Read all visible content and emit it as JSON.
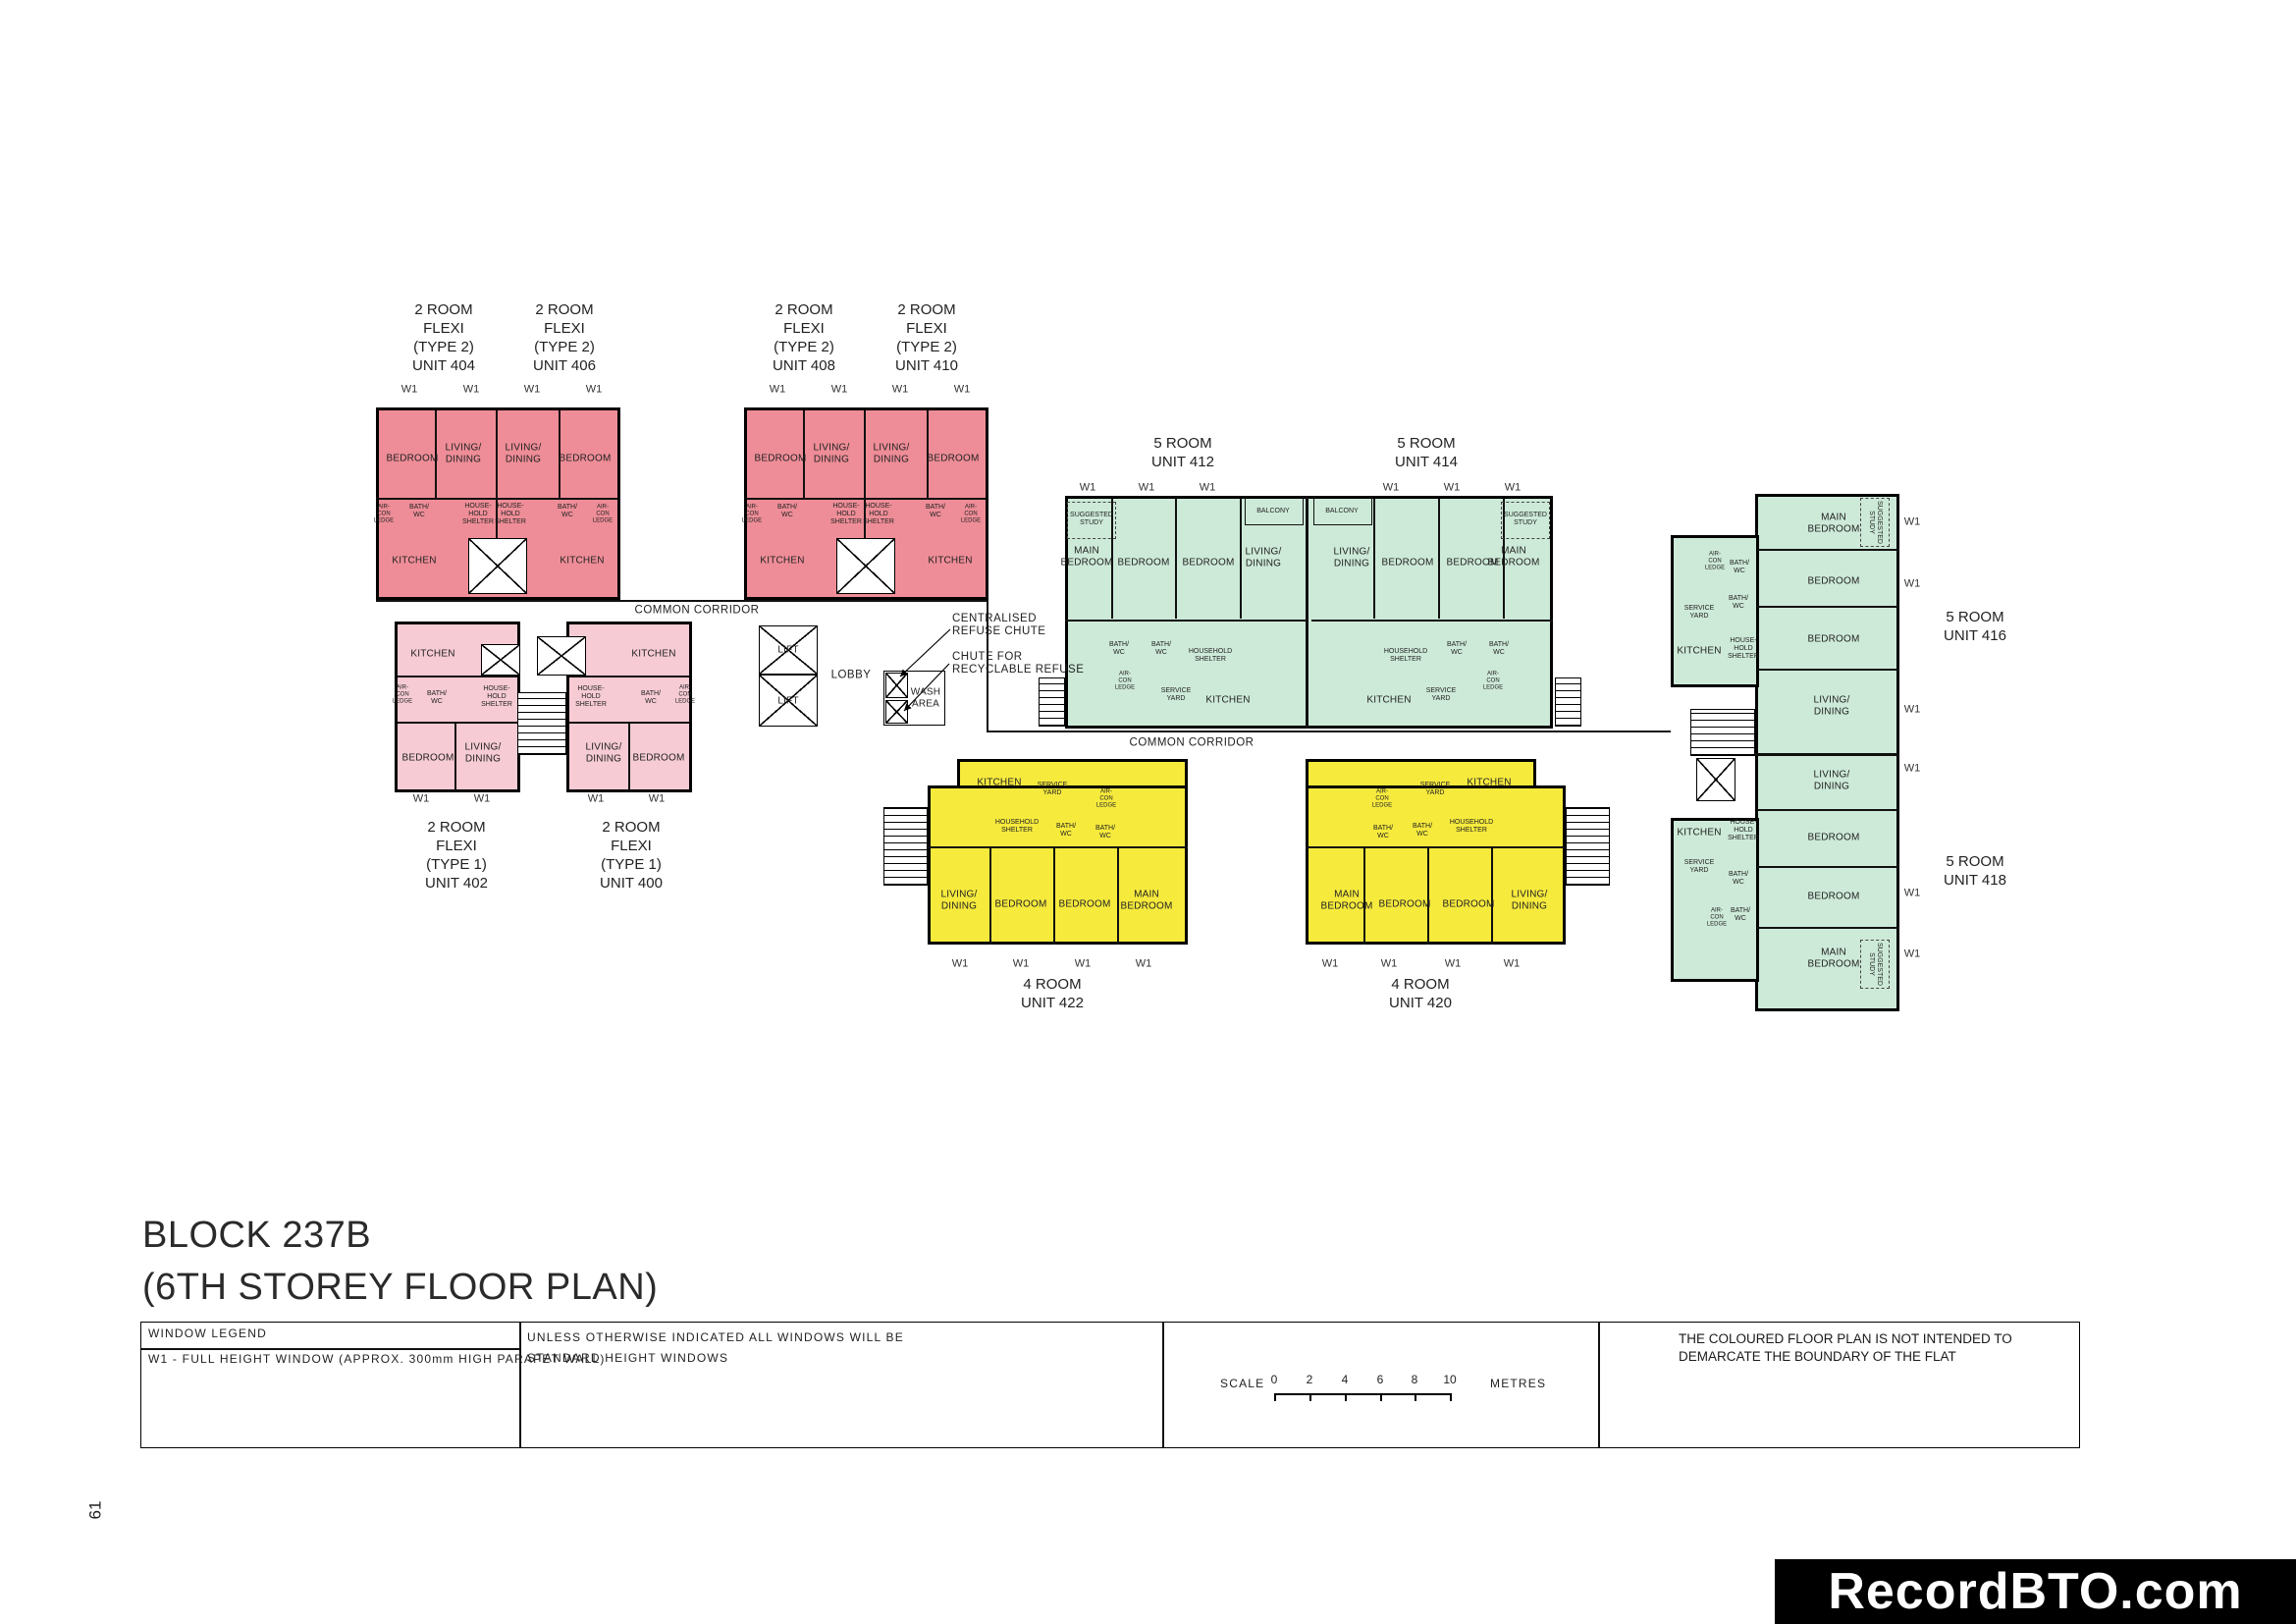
{
  "page": {
    "number": "61",
    "brand": "RecordBTO.com",
    "title": "BLOCK 237B\n(6TH STOREY FLOOR PLAN)"
  },
  "labels": {
    "w1": "W1",
    "common_corridor": "COMMON CORRIDOR",
    "lift": "LIFT",
    "lobby": "LOBBY",
    "wash_area": "WASH\nAREA",
    "centralised_refuse_chute": "CENTRALISED\nREFUSE CHUTE",
    "recyclable_chute": "CHUTE FOR\nRECYCLABLE REFUSE"
  },
  "rooms": {
    "bedroom": "BEDROOM",
    "main_bedroom": "MAIN\nBEDROOM",
    "living_dining": "LIVING/\nDINING",
    "kitchen": "KITCHEN",
    "bath_wc": "BATH/\nWC",
    "household_shelter": "HOUSEHOLD\nSHELTER",
    "household_shelter_small": "HOUSE-\nHOLD\nSHELTER",
    "aircon_ledge": "AIR-\nCON\nLEDGE",
    "service_yard": "SERVICE\nYARD",
    "suggested_study": "SUGGESTED\nSTUDY",
    "balcony": "BALCONY"
  },
  "units": {
    "u404": {
      "title": "2 ROOM\nFLEXI\n(TYPE 2)\nUNIT 404"
    },
    "u406": {
      "title": "2 ROOM\nFLEXI\n(TYPE 2)\nUNIT 406"
    },
    "u408": {
      "title": "2 ROOM\nFLEXI\n(TYPE 2)\nUNIT 408"
    },
    "u410": {
      "title": "2 ROOM\nFLEXI\n(TYPE 2)\nUNIT 410"
    },
    "u402": {
      "title": "2 ROOM\nFLEXI\n(TYPE 1)\nUNIT 402"
    },
    "u400": {
      "title": "2 ROOM\nFLEXI\n(TYPE 1)\nUNIT 400"
    },
    "u412": {
      "title": "5 ROOM\nUNIT 412"
    },
    "u414": {
      "title": "5 ROOM\nUNIT 414"
    },
    "u416": {
      "title": "5 ROOM\nUNIT 416"
    },
    "u418": {
      "title": "5 ROOM\nUNIT 418"
    },
    "u422": {
      "title": "4 ROOM\nUNIT 422"
    },
    "u420": {
      "title": "4 ROOM\nUNIT 420"
    }
  },
  "legend": {
    "window_legend_title": "WINDOW LEGEND",
    "window_legend_item": "W1 - FULL HEIGHT WINDOW (APPROX. 300mm HIGH PARAPET WALL)",
    "windows_note": "UNLESS OTHERWISE INDICATED ALL WINDOWS WILL BE\nSTANDARD HEIGHT WINDOWS",
    "scale_label": "SCALE",
    "scale_ticks": [
      "0",
      "2",
      "4",
      "6",
      "8",
      "10"
    ],
    "scale_unit": "METRES",
    "disclaimer": "THE COLOURED FLOOR PLAN IS NOT INTENDED TO\nDEMARCATE THE BOUNDARY OF THE FLAT"
  },
  "colors": {
    "unit_2room_flexi_type2": "#ee8d97",
    "unit_2room_flexi_type1": "#f6cbd4",
    "unit_5room": "#cdead8",
    "unit_4room": "#f6ea3d",
    "wall": "#000000",
    "brand_bg": "#000000",
    "brand_text": "#ffffff"
  }
}
